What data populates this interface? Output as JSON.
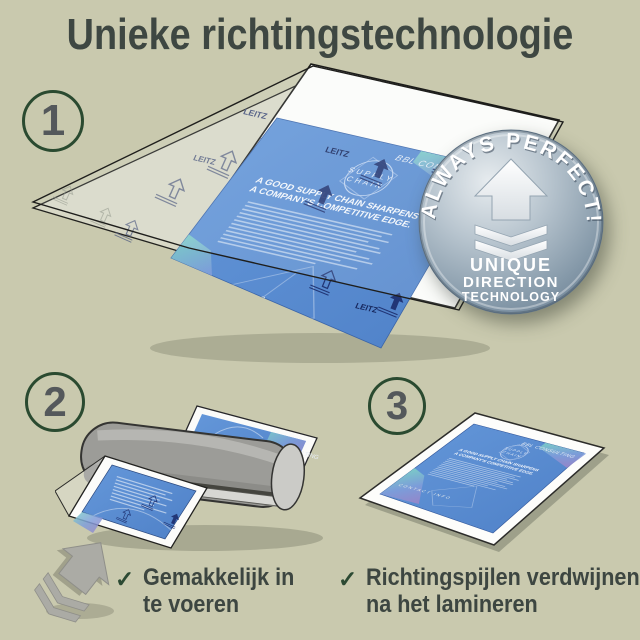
{
  "page": {
    "title": "Unieke richtingstechnologie"
  },
  "steps": [
    {
      "number": "1"
    },
    {
      "number": "2"
    },
    {
      "number": "3"
    }
  ],
  "badge": {
    "arc": "ALWAYS PERFECT!",
    "word1": "UNIQUE",
    "word2": "DIRECTION",
    "word3": "TECHNOLOGY",
    "icon": "up-arrow-with-chevrons"
  },
  "document": {
    "brand": "LEITZ",
    "company": "BBL CONSULTING",
    "logo1": "SUPPLY",
    "logo2": "CHAIN",
    "headline1": "A GOOD SUPPLY CHAIN SHARPENS",
    "headline2": "A COMPANY'S COMPETITIVE EDGE.",
    "contact": "CONTACT INFO"
  },
  "checklist": [
    {
      "mark": "✓",
      "line1": "Gemakkelijk in",
      "line2": "te voeren"
    },
    {
      "mark": "✓",
      "line1": "Richtingspijlen verdwijnen",
      "line2": "na het lamineren"
    }
  ],
  "colors": {
    "background": "#c9c9ae",
    "text": "#3e4742",
    "accent_green": "#2a4a30",
    "number_gray": "#54585b",
    "flyer_blue": "#5a8dd3",
    "arrow_navy": "#1d2f6e",
    "badge_steel": "#8ba0b4",
    "machine_gray": "#9c9c98"
  }
}
